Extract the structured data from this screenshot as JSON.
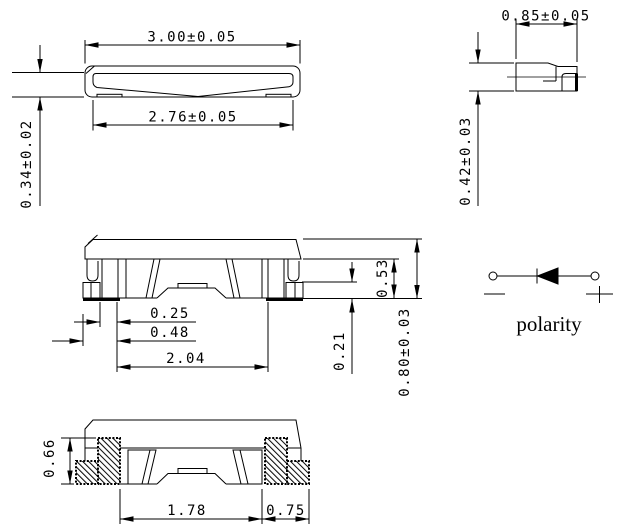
{
  "drawing": {
    "front_view": {
      "dims": {
        "overall_width": "3.00±0.05",
        "lens_width": "2.76±0.05",
        "profile_height": "0.34±0.02"
      }
    },
    "side_view": {
      "dims": {
        "overall_depth": "0.85±0.05",
        "overall_height": "0.42±0.03"
      }
    },
    "section_view": {
      "dims": {
        "lead_thickness": "0.25",
        "lead_foot_length": "0.48",
        "inner_lead_span": "2.04",
        "standoff": "0.21",
        "base_height": "0.53",
        "total_height": "0.80±0.03"
      }
    },
    "bottom_section_view": {
      "dims": {
        "lead_height": "0.66",
        "pad_span": "1.78",
        "pad_width": "0.75"
      }
    },
    "polarity": {
      "label": "polarity",
      "minus_symbol": "−",
      "plus_symbol": "+"
    },
    "colors": {
      "line": "#000000",
      "background": "#ffffff"
    }
  }
}
